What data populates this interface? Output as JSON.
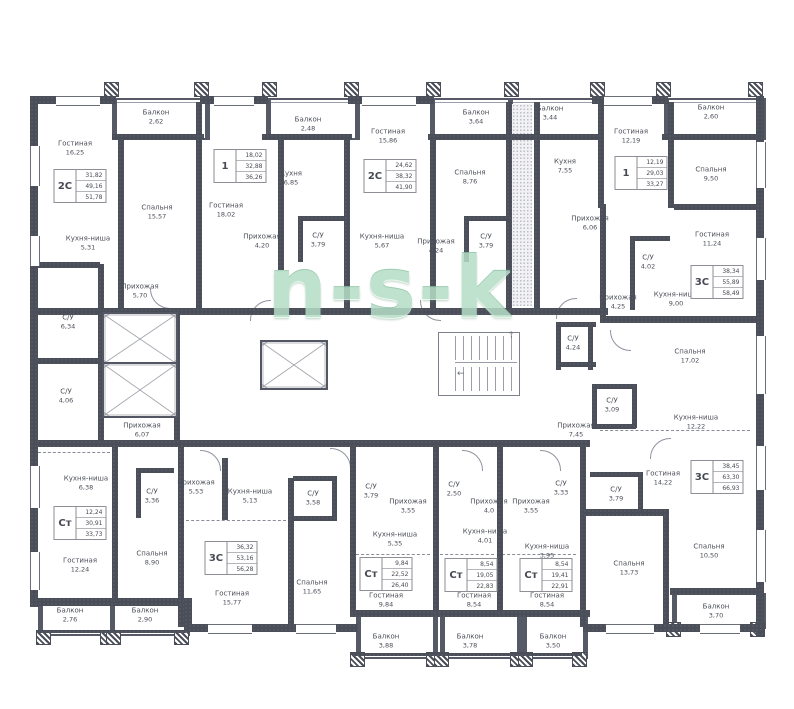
{
  "meta": {
    "watermark": "n-s-k"
  },
  "palette": {
    "wall": "#4a4e59",
    "room_fill": "#ffffff",
    "label_text": "#4b4e58",
    "table_border": "#8e8e96",
    "watermark_green": "#b5ddc6"
  },
  "rooms": [
    {
      "name": "Гостиная",
      "area": "16,25",
      "x": 75,
      "y": 148
    },
    {
      "name": "Кухня-ниша",
      "area": "5,31",
      "x": 88,
      "y": 243
    },
    {
      "name": "Спальня",
      "area": "15,57",
      "x": 157,
      "y": 212
    },
    {
      "name": "Балкон",
      "area": "2,62",
      "x": 156,
      "y": 117
    },
    {
      "name": "Прихожая",
      "area": "5,70",
      "x": 140,
      "y": 291
    },
    {
      "name": "С/У",
      "area": "6,34",
      "x": 68,
      "y": 322
    },
    {
      "name": "С/У",
      "area": "4,06",
      "x": 66,
      "y": 396
    },
    {
      "name": "Гостиная",
      "area": "18,02",
      "x": 226,
      "y": 210
    },
    {
      "name": "Прихожая",
      "area": "4,20",
      "x": 262,
      "y": 241
    },
    {
      "name": "Балкон",
      "area": "2,48",
      "x": 308,
      "y": 124
    },
    {
      "name": "Кухня",
      "area": "6,85",
      "x": 291,
      "y": 178
    },
    {
      "name": "С/У",
      "area": "3,79",
      "x": 318,
      "y": 240
    },
    {
      "name": "Гостиная",
      "area": "15,86",
      "x": 388,
      "y": 136
    },
    {
      "name": "Кухня-ниша",
      "area": "5,67",
      "x": 382,
      "y": 241
    },
    {
      "name": "Прихожая",
      "area": "4,24",
      "x": 436,
      "y": 246
    },
    {
      "name": "Спальня",
      "area": "8,76",
      "x": 470,
      "y": 177
    },
    {
      "name": "Балкон",
      "area": "3,64",
      "x": 476,
      "y": 117
    },
    {
      "name": "С/У",
      "area": "3,79",
      "x": 486,
      "y": 241
    },
    {
      "name": "Балкон",
      "area": "3,44",
      "x": 550,
      "y": 113
    },
    {
      "name": "Кухня",
      "area": "7,55",
      "x": 565,
      "y": 166
    },
    {
      "name": "Прихожая",
      "area": "6,06",
      "x": 590,
      "y": 223
    },
    {
      "name": "Гостиная",
      "area": "12,19",
      "x": 631,
      "y": 136
    },
    {
      "name": "С/У",
      "area": "4,02",
      "x": 648,
      "y": 262
    },
    {
      "name": "Спальня",
      "area": "9,50",
      "x": 711,
      "y": 174
    },
    {
      "name": "Балкон",
      "area": "2,60",
      "x": 711,
      "y": 112
    },
    {
      "name": "Гостиная",
      "area": "11,24",
      "x": 712,
      "y": 239
    },
    {
      "name": "Кухня-ниша",
      "area": "9,00",
      "x": 676,
      "y": 299
    },
    {
      "name": "Прихожая",
      "area": "4,25",
      "x": 618,
      "y": 302
    },
    {
      "name": "С/У",
      "area": "4,24",
      "x": 573,
      "y": 343
    },
    {
      "name": "Спальня",
      "area": "17,02",
      "x": 690,
      "y": 356
    },
    {
      "name": "С/У",
      "area": "3,09",
      "x": 612,
      "y": 405
    },
    {
      "name": "Прихожая",
      "area": "7,45",
      "x": 576,
      "y": 430
    },
    {
      "name": "Кухня-ниша",
      "area": "12,22",
      "x": 696,
      "y": 422
    },
    {
      "name": "Гостиная",
      "area": "14,22",
      "x": 663,
      "y": 478
    },
    {
      "name": "С/У",
      "area": "3,79",
      "x": 616,
      "y": 494
    },
    {
      "name": "Спальня",
      "area": "10,50",
      "x": 709,
      "y": 551
    },
    {
      "name": "Спальня",
      "area": "13,73",
      "x": 629,
      "y": 568
    },
    {
      "name": "Балкон",
      "area": "3,70",
      "x": 716,
      "y": 611
    },
    {
      "name": "С/У",
      "area": "3,33",
      "x": 561,
      "y": 488
    },
    {
      "name": "Прихожая",
      "area": "3,55",
      "x": 531,
      "y": 506
    },
    {
      "name": "Кухня-ниша",
      "area": "3,95",
      "x": 547,
      "y": 551
    },
    {
      "name": "Гостиная",
      "area": "8,54",
      "x": 547,
      "y": 600
    },
    {
      "name": "Балкон",
      "area": "3,50",
      "x": 553,
      "y": 641
    },
    {
      "name": "С/У",
      "area": "2,50",
      "x": 454,
      "y": 489
    },
    {
      "name": "Прихожая",
      "area": "4,0",
      "x": 489,
      "y": 506
    },
    {
      "name": "Кухня-ниша",
      "area": "4,01",
      "x": 485,
      "y": 536
    },
    {
      "name": "Гостиная",
      "area": "8,54",
      "x": 474,
      "y": 600
    },
    {
      "name": "Балкон",
      "area": "3,78",
      "x": 470,
      "y": 641
    },
    {
      "name": "С/У",
      "area": "3,79",
      "x": 371,
      "y": 491
    },
    {
      "name": "Прихожая",
      "area": "3,55",
      "x": 408,
      "y": 506
    },
    {
      "name": "Кухня-ниша",
      "area": "5,35",
      "x": 395,
      "y": 539
    },
    {
      "name": "Гостиная",
      "area": "9,84",
      "x": 386,
      "y": 600
    },
    {
      "name": "Балкон",
      "area": "3,88",
      "x": 386,
      "y": 641
    },
    {
      "name": "Спальня",
      "area": "11,65",
      "x": 312,
      "y": 587
    },
    {
      "name": "С/У",
      "area": "3,58",
      "x": 313,
      "y": 498
    },
    {
      "name": "Кухня-ниша",
      "area": "5,13",
      "x": 250,
      "y": 496
    },
    {
      "name": "Прихожая",
      "area": "5,53",
      "x": 196,
      "y": 487
    },
    {
      "name": "Гостиная",
      "area": "15,77",
      "x": 232,
      "y": 598
    },
    {
      "name": "Спальня",
      "area": "8,90",
      "x": 152,
      "y": 558
    },
    {
      "name": "Балкон",
      "area": "2,90",
      "x": 145,
      "y": 615
    },
    {
      "name": "С/У",
      "area": "3,36",
      "x": 152,
      "y": 496
    },
    {
      "name": "Кухня-ниша",
      "area": "6,38",
      "x": 86,
      "y": 483
    },
    {
      "name": "Гостиная",
      "area": "12,24",
      "x": 80,
      "y": 565
    },
    {
      "name": "Балкон",
      "area": "2,76",
      "x": 70,
      "y": 615
    },
    {
      "name": "Прихожая",
      "area": "6,07",
      "x": 142,
      "y": 430
    }
  ],
  "units": [
    {
      "type": "2С",
      "values": [
        "31,82",
        "49,16",
        "51,78"
      ],
      "x": 80,
      "y": 186
    },
    {
      "type": "1",
      "values": [
        "18,02",
        "32,88",
        "36,26"
      ],
      "x": 240,
      "y": 166
    },
    {
      "type": "2С",
      "values": [
        "24,62",
        "38,32",
        "41,90"
      ],
      "x": 390,
      "y": 176
    },
    {
      "type": "1",
      "values": [
        "12,19",
        "29,03",
        "33,27"
      ],
      "x": 641,
      "y": 173
    },
    {
      "type": "3С",
      "values": [
        "38,34",
        "55,89",
        "58,49"
      ],
      "x": 717,
      "y": 282
    },
    {
      "type": "3С",
      "values": [
        "38,45",
        "63,30",
        "66,93"
      ],
      "x": 717,
      "y": 477
    },
    {
      "type": "Ст",
      "values": [
        "12,24",
        "30,91",
        "33,73"
      ],
      "x": 80,
      "y": 523
    },
    {
      "type": "3С",
      "values": [
        "36,32",
        "53,16",
        "56,28"
      ],
      "x": 231,
      "y": 558
    },
    {
      "type": "Ст",
      "values": [
        "9,84",
        "22,52",
        "26,40"
      ],
      "x": 386,
      "y": 574
    },
    {
      "type": "Ст",
      "values": [
        "8,54",
        "19,05",
        "22,83"
      ],
      "x": 471,
      "y": 575
    },
    {
      "type": "Ст",
      "values": [
        "8,54",
        "19,41",
        "22,91"
      ],
      "x": 546,
      "y": 575
    }
  ]
}
